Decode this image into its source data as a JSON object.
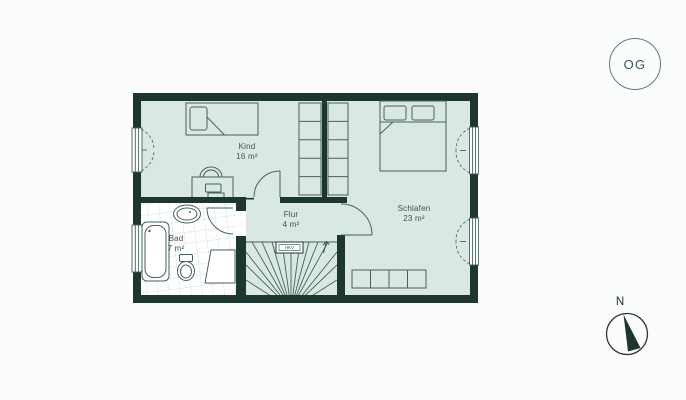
{
  "floor_plan": {
    "badge": "OG",
    "compass_label": "N",
    "rooms": [
      {
        "name": "Kind",
        "area": "16 m²"
      },
      {
        "name": "Schlafen",
        "area": "23 m²"
      },
      {
        "name": "Bad",
        "area": "7 m²"
      },
      {
        "name": "Flur",
        "area": "4 m²"
      }
    ],
    "annotations": {
      "hkv": "HKV"
    },
    "colors": {
      "wall": "#1d3630",
      "floor": "#d9e8e4",
      "line": "#44615a",
      "bath_tile": "#ccd9d5",
      "background": "#fbfcfc"
    }
  }
}
